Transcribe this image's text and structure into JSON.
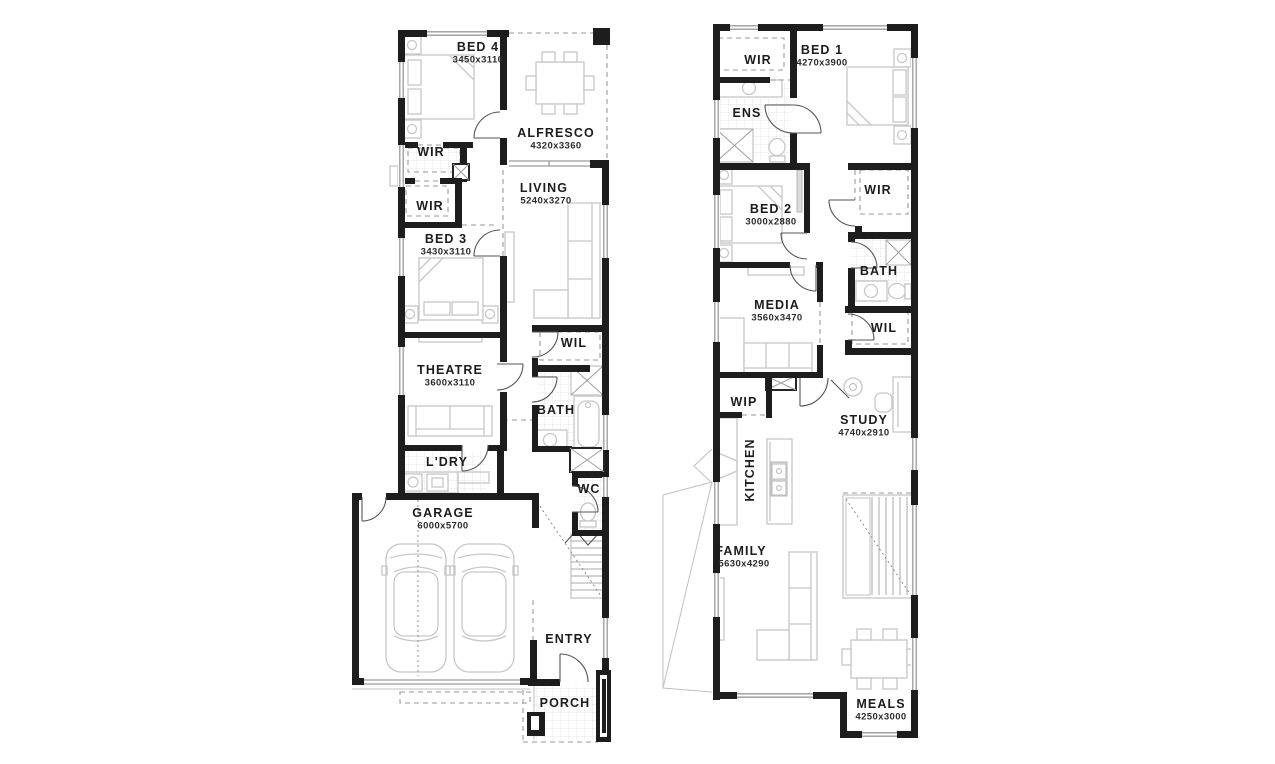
{
  "colors": {
    "wall": "#1d1d1d",
    "furniture_line": "#c7c7c7",
    "window_line": "#9a9a9a",
    "label_text": "#1c1c1c",
    "background": "#ffffff"
  },
  "plans": [
    {
      "name": "ground-floor",
      "rooms": [
        {
          "label": "BED 4",
          "dims": "3450x3110"
        },
        {
          "label": "ALFRESCO",
          "dims": "4320x3360"
        },
        {
          "label": "WIR"
        },
        {
          "label": "WIR"
        },
        {
          "label": "LIVING",
          "dims": "5240x3270"
        },
        {
          "label": "BED 3",
          "dims": "3430x3110"
        },
        {
          "label": "THEATRE",
          "dims": "3600x3110"
        },
        {
          "label": "WIL"
        },
        {
          "label": "BATH"
        },
        {
          "label": "L'DRY"
        },
        {
          "label": "WC"
        },
        {
          "label": "GARAGE",
          "dims": "6000x5700"
        },
        {
          "label": "ENTRY"
        },
        {
          "label": "PORCH"
        }
      ]
    },
    {
      "name": "first-floor",
      "rooms": [
        {
          "label": "WIR"
        },
        {
          "label": "BED 1",
          "dims": "4270x3900"
        },
        {
          "label": "ENS"
        },
        {
          "label": "BED 2",
          "dims": "3000x2880"
        },
        {
          "label": "WIR"
        },
        {
          "label": "BATH"
        },
        {
          "label": "MEDIA",
          "dims": "3560x3470"
        },
        {
          "label": "WIL"
        },
        {
          "label": "WIP"
        },
        {
          "label": "STUDY",
          "dims": "4740x2910"
        },
        {
          "label": "KITCHEN"
        },
        {
          "label": "FAMILY",
          "dims": "5630x4290"
        },
        {
          "label": "MEALS",
          "dims": "4250x3000"
        }
      ]
    }
  ]
}
